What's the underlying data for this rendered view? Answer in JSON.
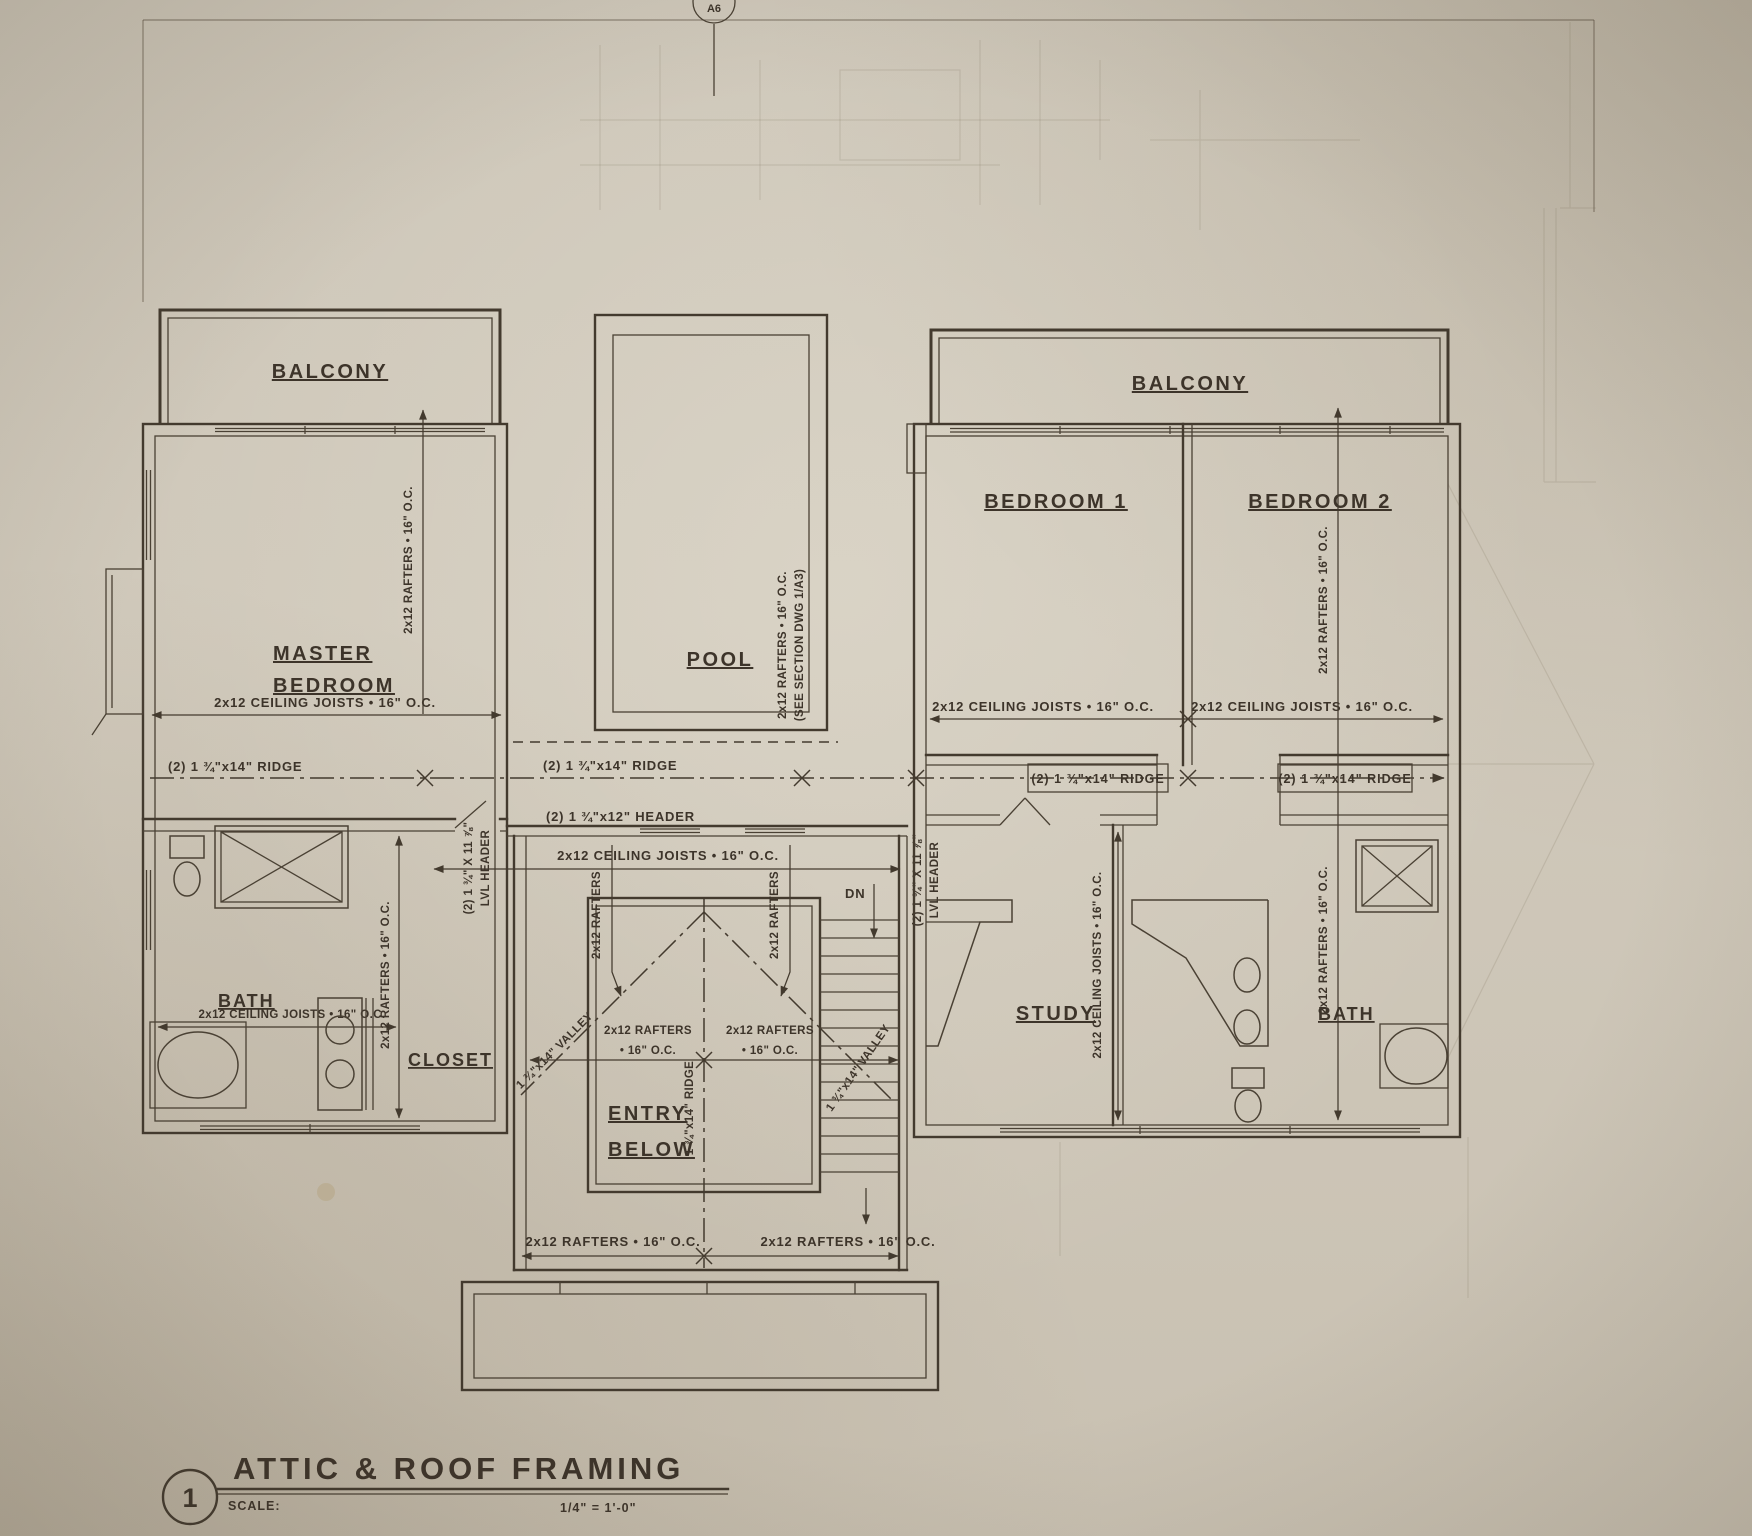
{
  "drawing": {
    "marker_top": "A6",
    "rooms": {
      "balcony_left": "BALCONY",
      "balcony_right": "BALCONY",
      "master_line1": "MASTER",
      "master_line2": "BEDROOM",
      "bath_left": "BATH",
      "closet": "CLOSET",
      "pool": "POOL",
      "entry_line1": "ENTRY",
      "entry_line2": "BELOW",
      "bedroom1": "BEDROOM 1",
      "bedroom2": "BEDROOM 2",
      "study": "STUDY",
      "bath_right": "BATH"
    },
    "annotations": {
      "ceiling_joists": "2x12 CEILING JOISTS • 16\" O.C.",
      "rafters": "2x12 RAFTERS • 16\" O.C.",
      "rafters_line1": "2x12 RAFTERS",
      "rafters_line2": "• 16\" O.C.",
      "ridge_2x14": "(2) 1 ¾\"x14\" RIDGE",
      "header_2x12": "(2) 1 ¾\"x12\" HEADER",
      "lvl_header_line1": "(2) 1 ¾\" X 11 ⅞\"",
      "lvl_header_line2": "LVL HEADER",
      "valley": "1 ¾\"x14\" VALLEY",
      "ridge_1x14": "1 ¾\"x14\" RIDGE",
      "pool_note_line1": "2x12 RAFTERS • 16\" O.C.",
      "pool_note_line2": "(SEE SECTION DWG 1/A3)",
      "down": "DN"
    },
    "title_block": {
      "detail_number": "1",
      "title": "ATTIC & ROOF FRAMING",
      "scale_label": "SCALE:",
      "scale_value": "1/4\" = 1'-0\""
    },
    "colors": {
      "paper": "#cfc8ba",
      "ink": "#3d342a"
    }
  }
}
